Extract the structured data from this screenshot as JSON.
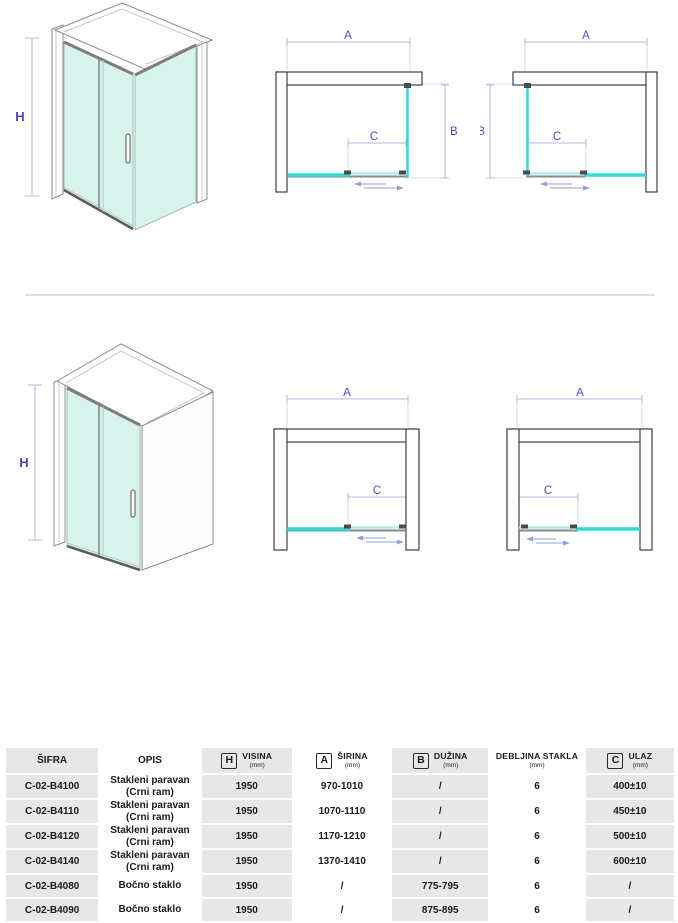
{
  "colors": {
    "glass_fill": "#d7f3ec",
    "glass_edge_bright": "#35d8d5",
    "glass_edge_pale": "#a9ecea",
    "dimension_line": "#b5b5e0",
    "dimension_label": "#4d4dca",
    "wall_outline": "#2f2f2f",
    "table_gray": "#e7e7e7"
  },
  "diagrams": {
    "top_iso": {
      "dim_h": "H"
    },
    "top_plan_left": {
      "dim_a": "A",
      "dim_b": "B",
      "dim_c": "C"
    },
    "top_plan_right": {
      "dim_a": "A",
      "dim_b": "B",
      "dim_c": "C"
    },
    "bottom_iso": {
      "dim_h": "H"
    },
    "bottom_plan_left": {
      "dim_a": "A",
      "dim_c": "C"
    },
    "bottom_plan_right": {
      "dim_a": "A",
      "dim_c": "C"
    }
  },
  "table": {
    "headers": {
      "sifra": "ŠIFRA",
      "opis": "OPIS",
      "visina": {
        "letter": "H",
        "title": "VISINA",
        "unit": "(mm)"
      },
      "sirina": {
        "letter": "A",
        "title": "ŠIRINA",
        "unit": "(mm)"
      },
      "duzina": {
        "letter": "B",
        "title": "DUŽINA",
        "unit": "(mm)"
      },
      "debljina": {
        "title": "DEBLJINA STAKLA",
        "unit": "(mm)"
      },
      "ulaz": {
        "letter": "C",
        "title": "ULAZ",
        "unit": "(mm)"
      }
    },
    "rows": [
      {
        "sifra": "C-02-B4100",
        "opis1": "Stakleni paravan",
        "opis2": "(Crni ram)",
        "visina": "1950",
        "sirina": "970-1010",
        "duzina": "/",
        "debljina": "6",
        "ulaz": "400±10"
      },
      {
        "sifra": "C-02-B4110",
        "opis1": "Stakleni paravan",
        "opis2": "(Crni ram)",
        "visina": "1950",
        "sirina": "1070-1110",
        "duzina": "/",
        "debljina": "6",
        "ulaz": "450±10"
      },
      {
        "sifra": "C-02-B4120",
        "opis1": "Stakleni paravan",
        "opis2": "(Crni ram)",
        "visina": "1950",
        "sirina": "1170-1210",
        "duzina": "/",
        "debljina": "6",
        "ulaz": "500±10"
      },
      {
        "sifra": "C-02-B4140",
        "opis1": "Stakleni paravan",
        "opis2": "(Crni ram)",
        "visina": "1950",
        "sirina": "1370-1410",
        "duzina": "/",
        "debljina": "6",
        "ulaz": "600±10"
      },
      {
        "sifra": "C-02-B4080",
        "opis1": "Bočno staklo",
        "opis2": "",
        "visina": "1950",
        "sirina": "/",
        "duzina": "775-795",
        "debljina": "6",
        "ulaz": "/"
      },
      {
        "sifra": "C-02-B4090",
        "opis1": "Bočno staklo",
        "opis2": "",
        "visina": "1950",
        "sirina": "/",
        "duzina": "875-895",
        "debljina": "6",
        "ulaz": "/"
      }
    ]
  }
}
